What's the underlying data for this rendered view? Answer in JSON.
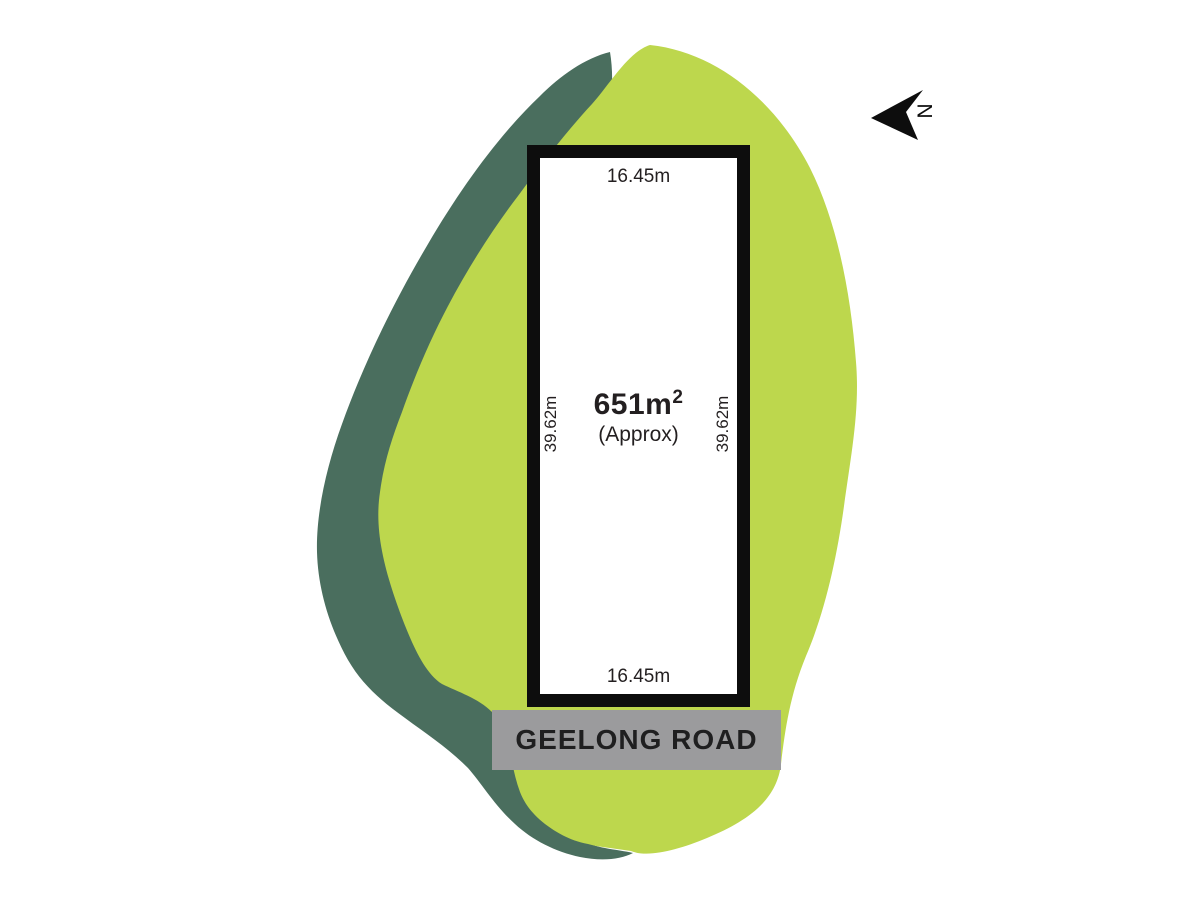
{
  "lot": {
    "area_value": "651m",
    "area_superscript": "2",
    "area_qualifier": "(Approx)",
    "frontage_top": "16.45m",
    "frontage_bottom": "16.45m",
    "depth_left": "39.62m",
    "depth_right": "39.62m"
  },
  "road": {
    "name": "GEELONG ROAD"
  },
  "compass": {
    "north_label": "N"
  },
  "colors": {
    "site_fill": "#bdd74d",
    "site_shadow": "#4a6e5e",
    "lot_border": "#0d0d0d",
    "lot_fill": "#ffffff",
    "road_fill": "#9b9b9d",
    "road_text": "#1f1f20",
    "dimension_text": "#231f20",
    "compass_color": "#0d0d0d"
  }
}
